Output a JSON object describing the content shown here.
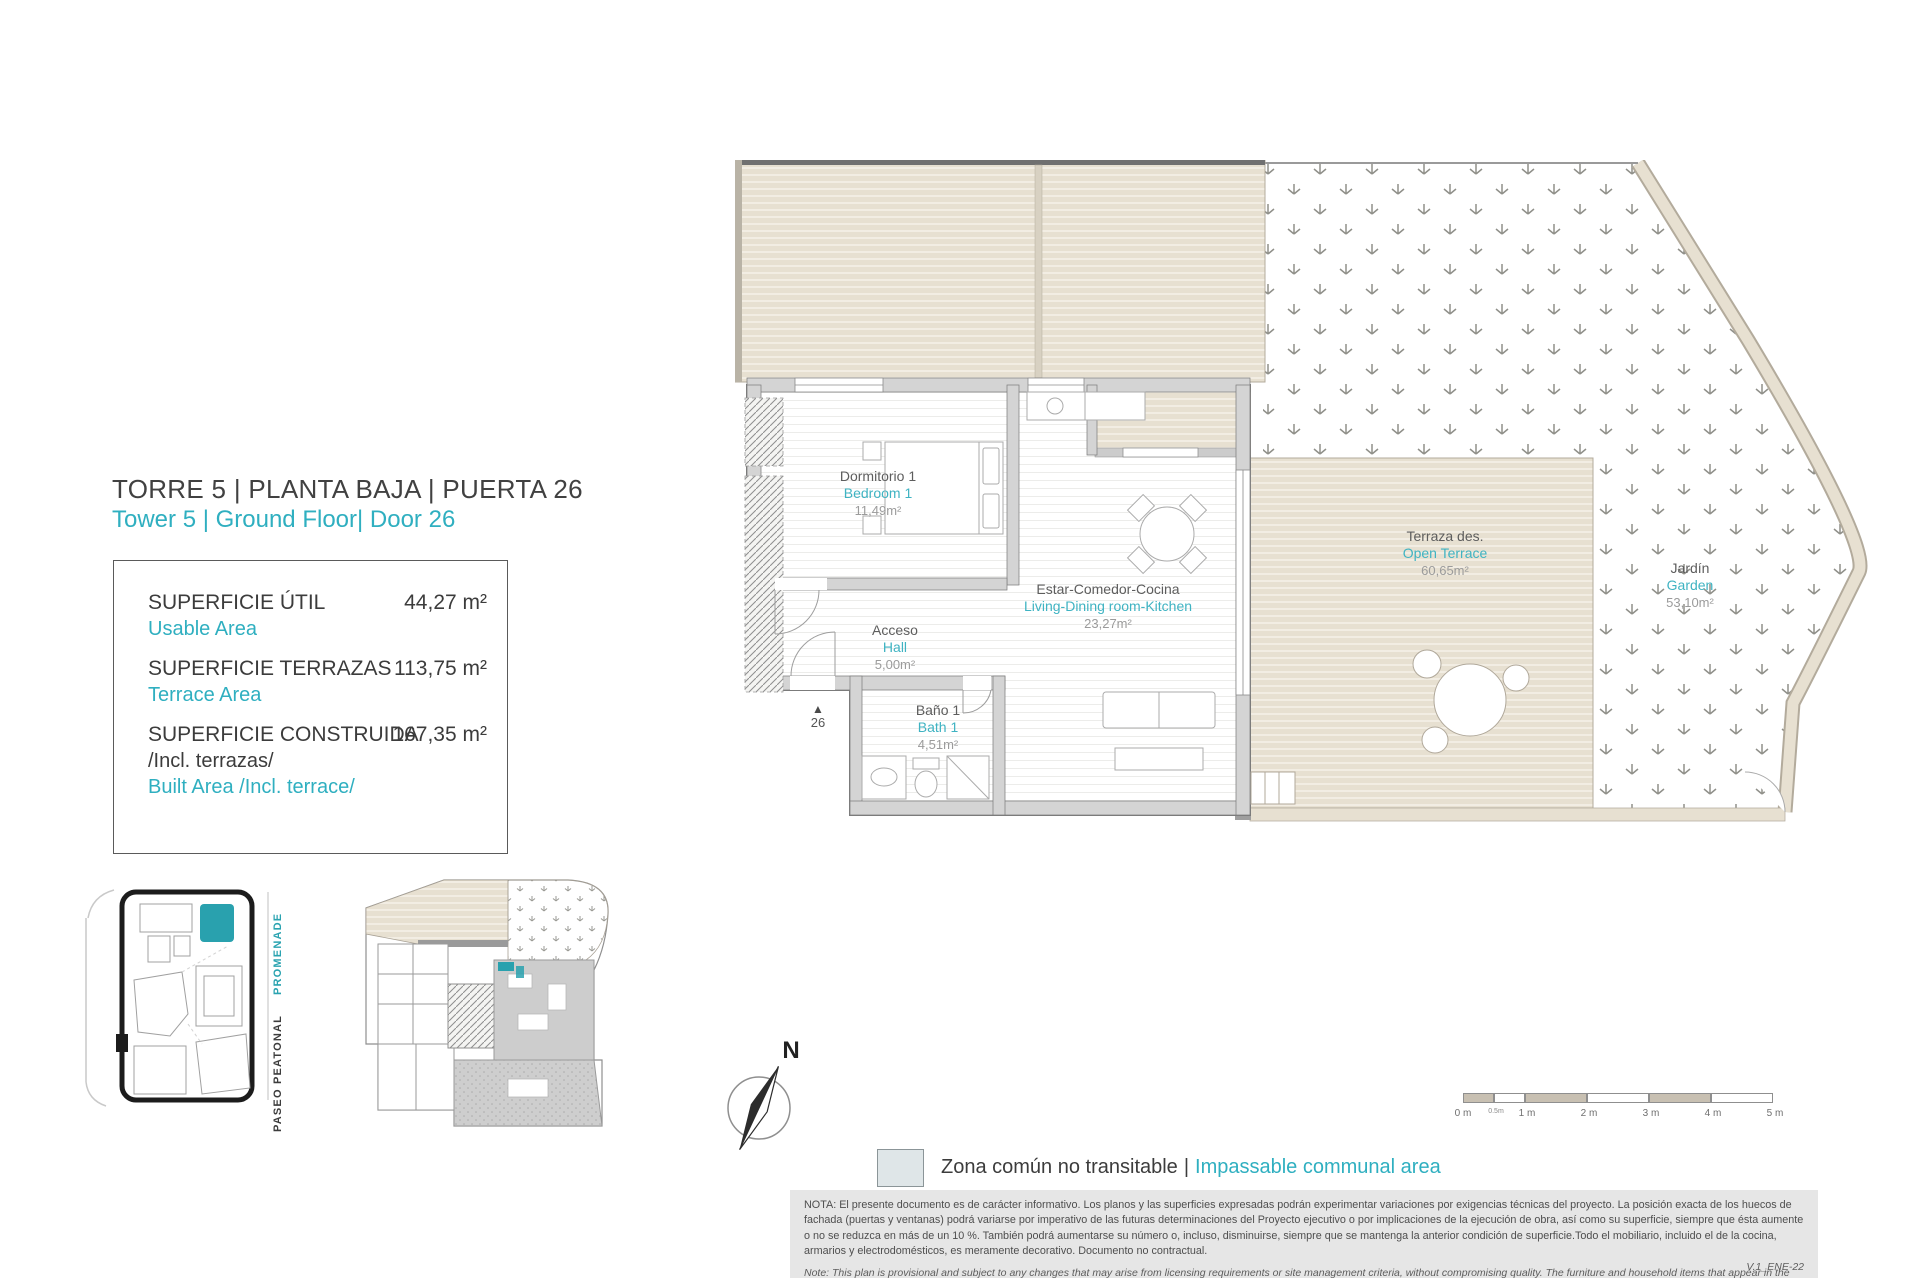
{
  "header": {
    "title_es": "TORRE 5 | PLANTA BAJA | PUERTA 26",
    "title_en": "Tower 5 | Ground Floor| Door 26"
  },
  "summary": {
    "rows": [
      {
        "label_es": "SUPERFICIE ÚTIL",
        "label_en": "Usable Area",
        "value": "44,27 m²"
      },
      {
        "label_es": "SUPERFICIE TERRAZAS",
        "label_en": "Terrace Area",
        "value": "113,75 m²"
      },
      {
        "label_es": "SUPERFICIE CONSTRUIDA",
        "note_es": "/Incl. terrazas/",
        "label_en": "Built Area /Incl. terrace/",
        "value": "167,35 m²"
      }
    ]
  },
  "plan": {
    "rooms": [
      {
        "name_es": "Dormitorio 1",
        "name_en": "Bedroom 1",
        "area": "11,49m²"
      },
      {
        "name_es": "Estar-Comedor-Cocina",
        "name_en": "Living-Dining room-Kitchen",
        "area": "23,27m²"
      },
      {
        "name_es": "Acceso",
        "name_en": "Hall",
        "area": "5,00m²"
      },
      {
        "name_es": "Baño 1",
        "name_en": "Bath 1",
        "area": "4,51m²"
      },
      {
        "name_es": "Terraza des.",
        "name_en": "Open Terrace",
        "area": "60,65m²"
      },
      {
        "name_es": "Jardín",
        "name_en": "Garden",
        "area": "53,10m²"
      }
    ],
    "entrance_number": "26",
    "compass_label": "N"
  },
  "keymap": {
    "promenade": "PROMENADE",
    "paseo": "PASEO PEATONAL"
  },
  "scalebar": {
    "labels": [
      "0 m",
      "0.5m",
      "1 m",
      "2 m",
      "3 m",
      "4 m",
      "5 m"
    ]
  },
  "legend": {
    "label_es": "Zona común no transitable",
    "separator": "|",
    "label_en": "Impassable communal area"
  },
  "notes": {
    "es": "NOTA:  El presente documento es de carácter informativo. Los planos y las superficies expresadas podrán experimentar variaciones por exigencias técnicas del proyecto. La posición exacta de los huecos de fachada (puertas y ventanas) podrá variarse por imperativo de las futuras determinaciones del Proyecto ejecutivo o por implicaciones de la ejecución de obra, así como su superficie, siempre que ésta aumente o no se reduzca en más de un 10 %. También podrá aumentarse su número o, incluso, disminuirse, siempre que se mantenga la anterior condición de superficie.Todo el mobiliario, incluido el de la cocina, armarios y electrodomésticos, es meramente decorativo. Documento no contractual.",
    "en": "Note: This plan is provisional and subject to any changes that may arise from licensing requirements or site management criteria, without compromising quality. The furniture and household items that appear in the plan are merely for decorative purposes. This is a non-contractual document. The imperative determinations of the Executive Project or by implications works of the execution, can change the exact position of the facade of doors and windows, as well the surface area may also be increased or even decrease not more than a 10%.",
    "version": "V.1_ENE-22"
  },
  "colors": {
    "teal": "#2fafc0",
    "teal_fill": "#29a1ae",
    "beige": "#e7e0d1",
    "beige_border": "#b3ab9c",
    "wall_gray": "#d4d4d4",
    "wall_stroke": "#7e7e7e",
    "text_dark": "#3f3f3f",
    "area_gray": "#9b9b9b",
    "legend_swatch": "#dfe6e8",
    "note_bg": "#e6e6e6"
  }
}
